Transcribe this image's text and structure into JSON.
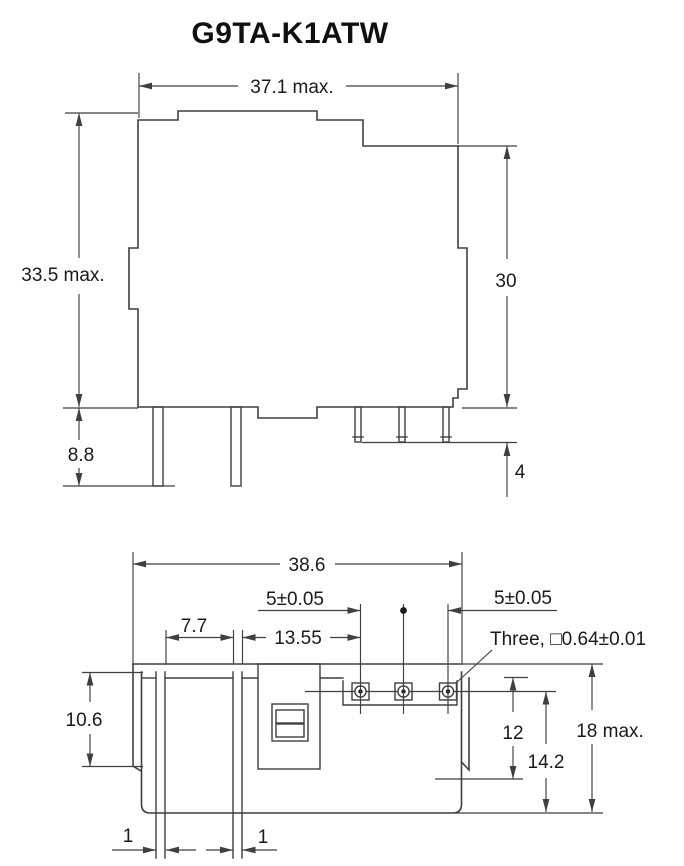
{
  "title": "G9TA-K1ATW",
  "colors": {
    "line": "#3f3f3f",
    "text": "#1a1a1a"
  },
  "top_view": {
    "dims": {
      "width": "37.1 max.",
      "height": "33.5 max.",
      "case_height": "30",
      "terminal_length": "8.8",
      "pin_length": "4"
    }
  },
  "bottom_view": {
    "dims": {
      "overall_width": "38.6",
      "pin_pitch_left": "5±0.05",
      "pin_pitch_right": "5±0.05",
      "terminal_gap": "7.7",
      "pin_offset": "13.55",
      "pin_note": "Three, □0.64±0.01",
      "flange_depth": "10.6",
      "pin_plane_depth": "12",
      "terminal_plane_depth": "14.2",
      "overall_depth": "18 max.",
      "terminal_thickness_left": "1",
      "terminal_thickness_right": "1"
    }
  }
}
